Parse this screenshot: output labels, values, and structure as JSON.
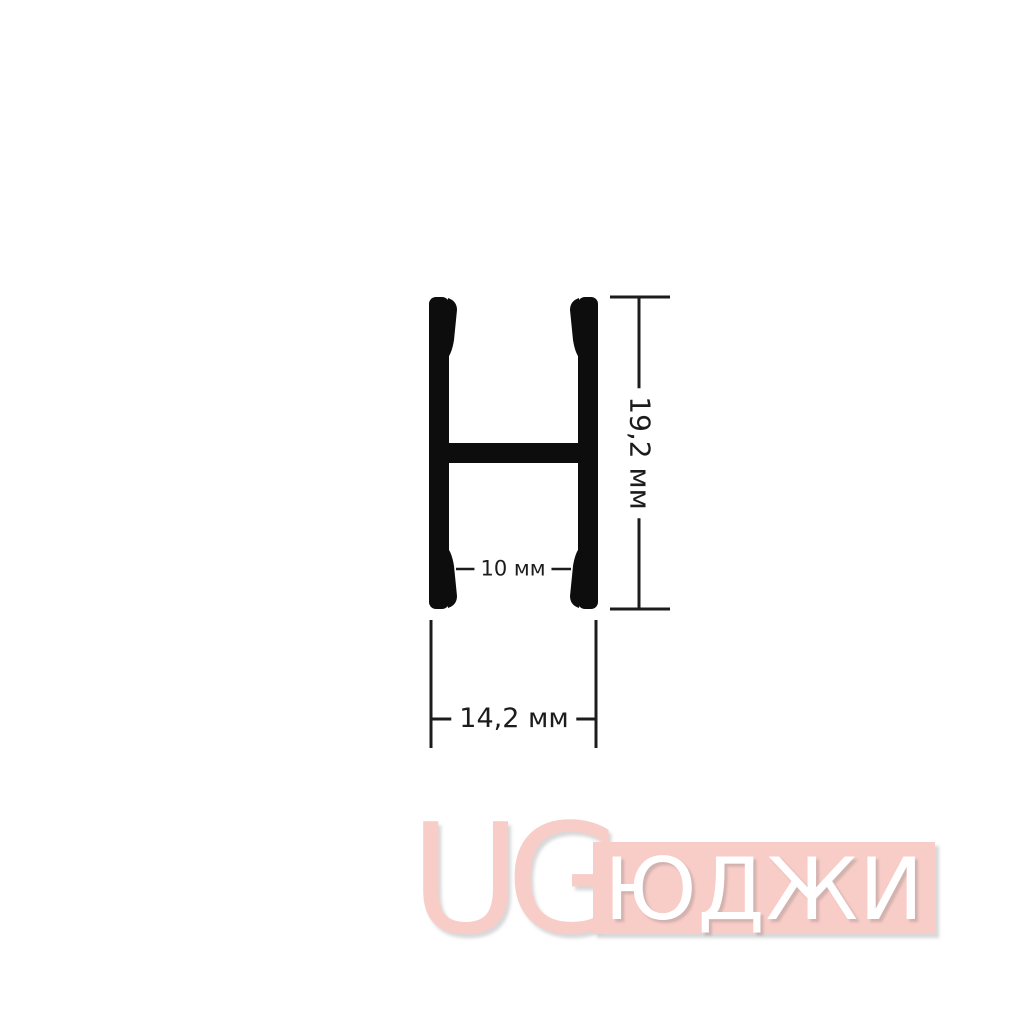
{
  "diagram": {
    "shape": "H-profile-cross-section",
    "dimensions": {
      "height": {
        "label": "19,2 мм",
        "value": "19,2",
        "unit": "мм"
      },
      "inner_width": {
        "label": "10 мм",
        "value": "10",
        "unit": "мм"
      },
      "overall_width": {
        "label": "14,2 мм",
        "value": "14,2",
        "unit": "мм"
      }
    },
    "colors": {
      "profile": "#0d0d0d",
      "dimension_lines": "#1c1c1c",
      "background": "#ffffff"
    }
  },
  "watermark": {
    "logo": "UG",
    "brand": "ЮДЖИ",
    "colors": {
      "pink": "#f8ccc7",
      "letters": "#ffffff"
    }
  }
}
